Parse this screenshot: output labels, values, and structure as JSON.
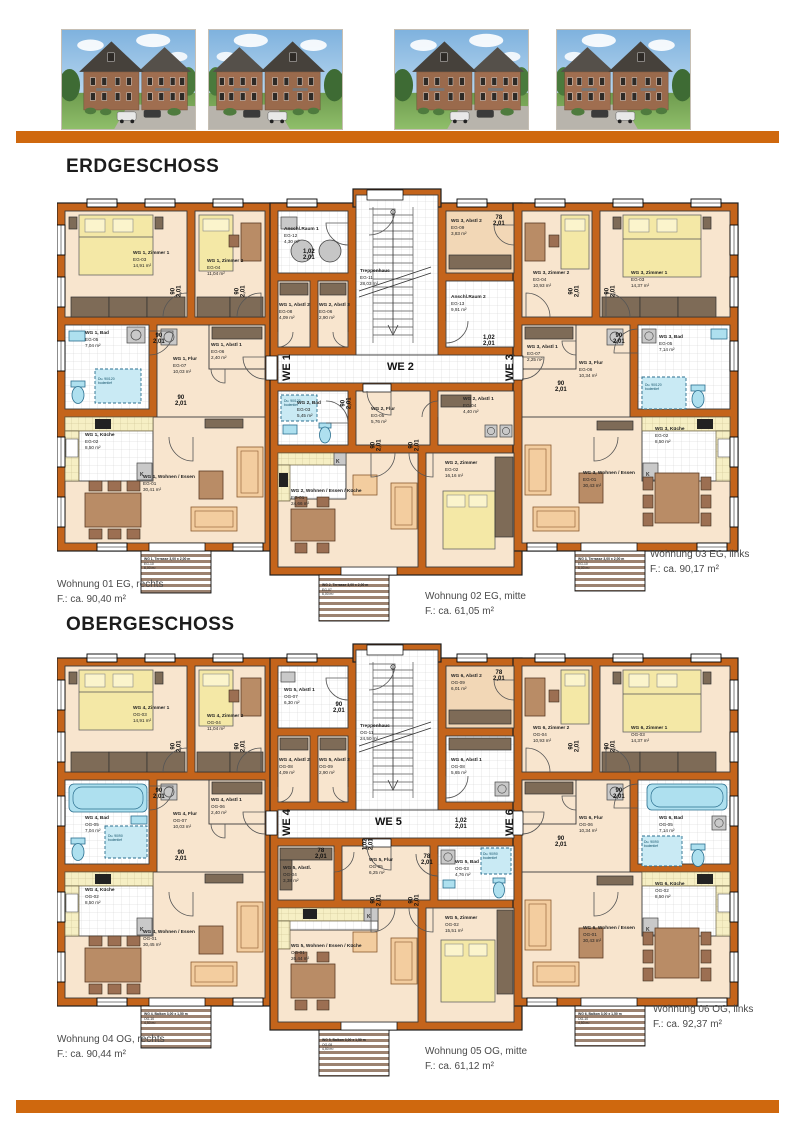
{
  "shared": {
    "dims": {
      "w90": "90",
      "w78": "78",
      "w102": "1,02",
      "h": "2,01"
    },
    "k_label": "K"
  },
  "floors": [
    {
      "title": "ERDGESCHOSS",
      "we_labels": [
        "WE 1",
        "WE 2",
        "WE 3"
      ],
      "rooms": [
        {
          "name": "WG 1, Zimmer 1",
          "code": "EG-03",
          "area": "14,91 m²"
        },
        {
          "name": "WG 1, Zimmer 2",
          "code": "EG-04",
          "area": "11,04 m²"
        },
        {
          "name": "WG 1, Bad",
          "code": "EG-05",
          "area": "7,04 m²"
        },
        {
          "name": "WG 1, Abstl 1",
          "code": "EG-06",
          "area": "2,40 m²"
        },
        {
          "name": "WG 1, Flur",
          "code": "EG-07",
          "area": "10,03 m²"
        },
        {
          "name": "WG 1, Küche",
          "code": "EG-02",
          "area": "8,50 m²"
        },
        {
          "name": "WG 1, Wohnen / Essen",
          "code": "EG-01",
          "area": "30,41 m²"
        },
        {
          "name": "Anschl.Raum 1",
          "code": "EG-12",
          "area": "4,30 m²"
        },
        {
          "name": "WG 1, Abstl 2",
          "code": "EG-08",
          "area": "4,09 m²"
        },
        {
          "name": "WG 2, Abstl 3",
          "code": "EG-06",
          "area": "2,90 m²"
        },
        {
          "name": "Treppenhaus",
          "code": "EG-11",
          "area": "28,03 m²"
        },
        {
          "name": "WG 3, Abstl 2",
          "code": "EG-09",
          "area": "3,83 m²"
        },
        {
          "name": "Anschl.Raum 2",
          "code": "EG-13",
          "area": "9,91 m²"
        },
        {
          "name": "WG 2, Bad",
          "code": "EG-03",
          "area": "5,45 m²"
        },
        {
          "name": "WG 2, Flur",
          "code": "EG-05",
          "area": "5,76 m²"
        },
        {
          "name": "WG 2, Abstl 1",
          "code": "EG-04",
          "area": "4,40 m²"
        },
        {
          "name": "WG 2, Zimmer",
          "code": "EG-02",
          "area": "16,16 m²"
        },
        {
          "name": "WG 2, Wohnen / Essen / Küche",
          "code": "EG-01",
          "area": "24,66 m²"
        },
        {
          "name": "WG 3, Zimmer 2",
          "code": "EG-04",
          "area": "10,93 m²"
        },
        {
          "name": "WG 3, Zimmer 1",
          "code": "EG-03",
          "area": "14,37 m²"
        },
        {
          "name": "WG 3, Bad",
          "code": "EG-05",
          "area": "7,14 m²"
        },
        {
          "name": "WG 3, Flur",
          "code": "EG-06",
          "area": "10,34 m²"
        },
        {
          "name": "WG 3, Abstl 1",
          "code": "EG-07",
          "area": "2,25 m²"
        },
        {
          "name": "WG 3, Küche",
          "code": "EG-02",
          "area": "8,50 m²"
        },
        {
          "name": "WG 3, Wohnen / Essen",
          "code": "EG-01",
          "area": "30,43 m²"
        }
      ],
      "outdoor": [
        {
          "name": "WG 1, Terrasse 3,00 x 2,00 m",
          "code": "EG-10",
          "area": "6,00 m²"
        },
        {
          "name": "WG 2, Terrasse 3,00 x 2,00 m",
          "code": "EG-07",
          "area": "6,00 m²"
        },
        {
          "name": "WG 3, Terrasse 3,00 x 2,00 m",
          "code": "EG-10",
          "area": "6,00 m²"
        }
      ],
      "apartments": [
        {
          "label": "Wohnung 01 EG, rechts",
          "area": "F.: ca. 90,40 m²"
        },
        {
          "label": "Wohnung 02 EG, mitte",
          "area": "F.: ca. 61,05 m²"
        },
        {
          "label": "Wohnung 03 EG, links",
          "area": "F.: ca. 90,17 m²"
        }
      ],
      "shower_note": [
        "Du. 90/120",
        "bodentief"
      ]
    },
    {
      "title": "OBERGESCHOSS",
      "we_labels": [
        "WE 4",
        "WE 5",
        "WE 6"
      ],
      "rooms": [
        {
          "name": "WG 4, Zimmer 1",
          "code": "OG-03",
          "area": "14,91 m²"
        },
        {
          "name": "WG 4, Zimmer 2",
          "code": "OG-04",
          "area": "11,04 m²"
        },
        {
          "name": "WG 4, Bad",
          "code": "OG-05",
          "area": "7,04 m²"
        },
        {
          "name": "WG 4, Abstl 1",
          "code": "OG-06",
          "area": "2,40 m²"
        },
        {
          "name": "WG 4, Flur",
          "code": "OG-07",
          "area": "10,03 m²"
        },
        {
          "name": "WG 4, Küche",
          "code": "OG-02",
          "area": "8,50 m²"
        },
        {
          "name": "WG 4, Wohnen / Essen",
          "code": "OG-01",
          "area": "30,45 m²"
        },
        {
          "name": "WG 5, Abstl 1",
          "code": "OG-07",
          "area": "6,30 m²"
        },
        {
          "name": "WG 4, Abstl 2",
          "code": "OG-08",
          "area": "4,09 m²"
        },
        {
          "name": "WG 5, Abstl 2",
          "code": "OG-09",
          "area": "2,90 m²"
        },
        {
          "name": "Treppenhaus",
          "code": "OG-11",
          "area": "24,50 m²"
        },
        {
          "name": "WG 6, Abstl 2",
          "code": "OG-09",
          "area": "6,01 m²"
        },
        {
          "name": "WG 6, Abstl 1",
          "code": "OG-08",
          "area": "5,65 m²"
        },
        {
          "name": "WG 5, Abstl.",
          "code": "OG-04",
          "area": "3,38 m²"
        },
        {
          "name": "WG 5, Flur",
          "code": "OG-05",
          "area": "6,25 m²"
        },
        {
          "name": "WG 5, Bad",
          "code": "OG-03",
          "area": "4,76 m²"
        },
        {
          "name": "WG 5, Zimmer",
          "code": "OG-02",
          "area": "15,51 m²"
        },
        {
          "name": "WG 5, Wohnen / Essen / Küche",
          "code": "OG-01",
          "area": "26,44 m²"
        },
        {
          "name": "WG 6, Zimmer 2",
          "code": "OG-04",
          "area": "10,93 m²"
        },
        {
          "name": "WG 6, Zimmer 1",
          "code": "OG-03",
          "area": "14,37 m²"
        },
        {
          "name": "WG 6, Bad",
          "code": "OG-05",
          "area": "7,14 m²"
        },
        {
          "name": "WG 6, Flur",
          "code": "OG-06",
          "area": "10,34 m²"
        },
        {
          "name": "WG 6, Küche",
          "code": "OG-02",
          "area": "8,50 m²"
        },
        {
          "name": "WG 6, Wohnen / Essen",
          "code": "OG-01",
          "area": "30,43 m²"
        }
      ],
      "outdoor": [
        {
          "name": "WG 4, Balkon 3,00 x 1,50 m",
          "code": "OG-10",
          "area": "4,50 m²"
        },
        {
          "name": "WG 5, Balkon 3,00 x 1,50 m",
          "code": "OG-08",
          "area": "4,50 m²"
        },
        {
          "name": "WG 6, Balkon 3,00 x 1,50 m",
          "code": "OG-10",
          "area": "4,50 m²"
        }
      ],
      "apartments": [
        {
          "label": "Wohnung 04 OG, rechts",
          "area": "F.: ca. 90,44 m²"
        },
        {
          "label": "Wohnung 05 OG, mitte",
          "area": "F.: ca. 61,12 m²"
        },
        {
          "label": "Wohnung 06 OG, links",
          "area": "F.: ca. 92,37 m²"
        }
      ],
      "shower_note": [
        "Du. 90/90",
        "bodentief"
      ]
    }
  ]
}
